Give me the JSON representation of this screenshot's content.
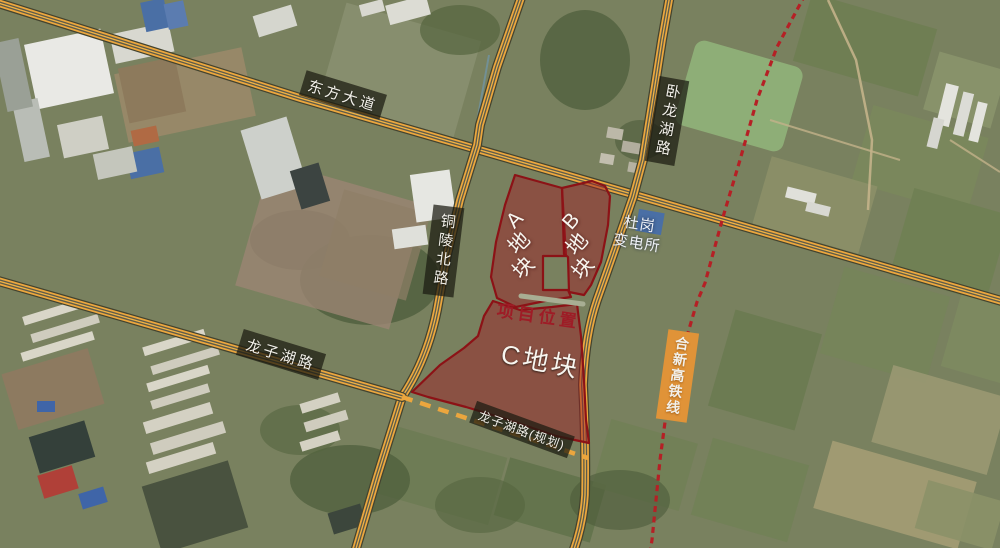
{
  "map": {
    "description": "satellite annotation map of project parcels",
    "roads": [
      {
        "id": "dongfang-dadao",
        "name": "东方大道"
      },
      {
        "id": "wolonghu-lu",
        "name": "卧龙湖路"
      },
      {
        "id": "tongling-bei-lu",
        "name": "铜陵北路"
      },
      {
        "id": "longzihu-lu",
        "name": "龙子湖路"
      },
      {
        "id": "longzihu-lu-planned",
        "name": "龙子湖路(规划)"
      },
      {
        "id": "hexin-gaotie",
        "name": "合新高铁线"
      }
    ],
    "pois": [
      {
        "id": "dugang-substation",
        "name": "杜岗变电所",
        "line1": "杜岗",
        "line2": "变电所"
      }
    ],
    "parcels": [
      {
        "id": "A",
        "label": "A地块",
        "chars": [
          "A",
          "地",
          "块"
        ]
      },
      {
        "id": "B",
        "label": "B地块",
        "chars": [
          "B",
          "地",
          "块"
        ]
      },
      {
        "id": "C",
        "label": "C地块"
      }
    ],
    "annotations": [
      {
        "id": "project-location",
        "text": "项目位置"
      }
    ]
  },
  "colors": {
    "road_orange": "#ECA73E",
    "railway_red": "#B52025",
    "parcel_fill": "rgba(158,28,36,0.47)",
    "parcel_stroke": "#8C1216",
    "label_box_bg": "rgba(26,26,16,0.72)",
    "rail_label_bg": "#E09338",
    "project_red": "#9E1C26"
  }
}
